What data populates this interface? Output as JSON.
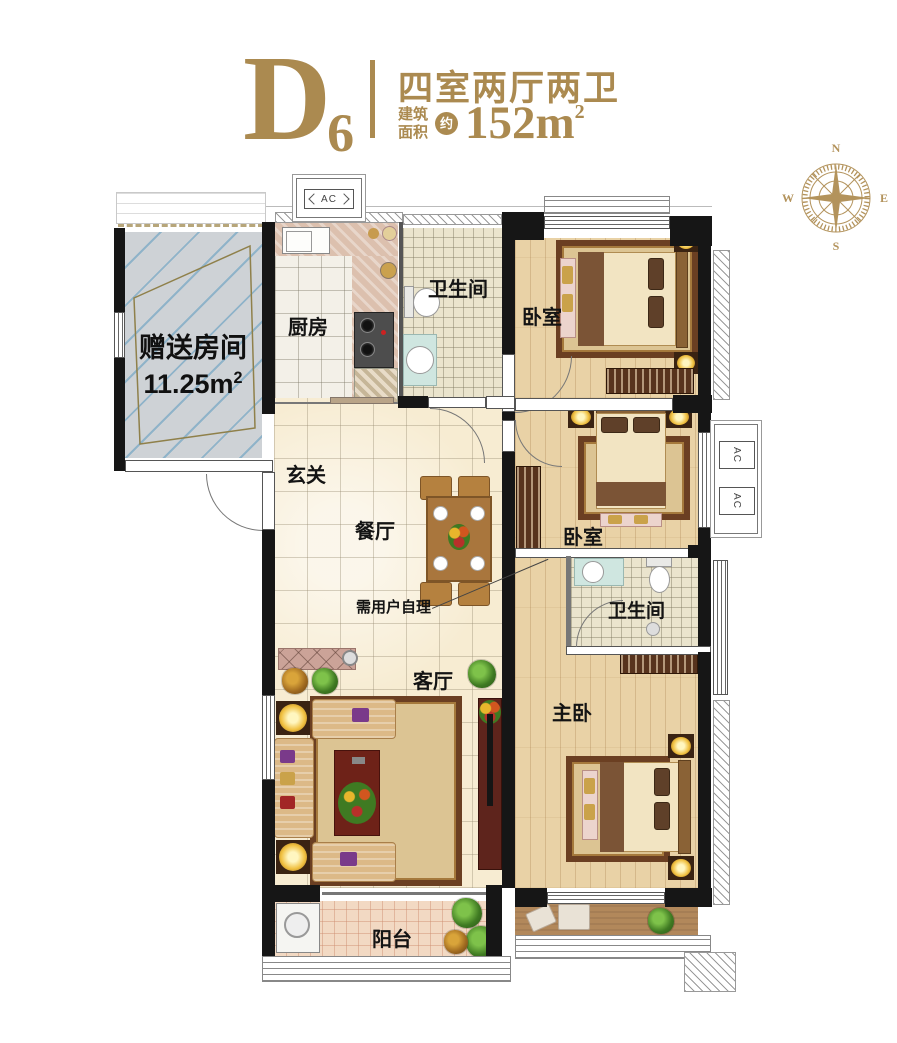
{
  "header": {
    "unit_code": "D",
    "unit_sub": "6",
    "layout_title": "四室两厅两卫",
    "area_label_top": "建筑",
    "area_label_bottom": "面积",
    "area_approx": "约",
    "area_value": "152m",
    "area_sup": "2"
  },
  "compass": {
    "n": "N",
    "e": "E",
    "s": "S",
    "w": "W"
  },
  "rooms": {
    "gift_room": {
      "label": "赠送房间",
      "area": "11.25m",
      "area_sup": "2"
    },
    "kitchen": {
      "label": "厨房"
    },
    "bath_top": {
      "label": "卫生间"
    },
    "bedroom_top": {
      "label": "卧室"
    },
    "entry": {
      "label": "玄关"
    },
    "dining": {
      "label": "餐厅"
    },
    "bedroom_mid": {
      "label": "卧室"
    },
    "bath_master": {
      "label": "卫生间"
    },
    "living": {
      "label": "客厅"
    },
    "master_bedroom": {
      "label": "主卧"
    },
    "balcony": {
      "label": "阳台"
    }
  },
  "annotations": {
    "self_provided": "需用户自理",
    "ac_unit": "AC"
  },
  "colors": {
    "accent_gold": "#ab8a50",
    "wall_black": "#161616"
  }
}
